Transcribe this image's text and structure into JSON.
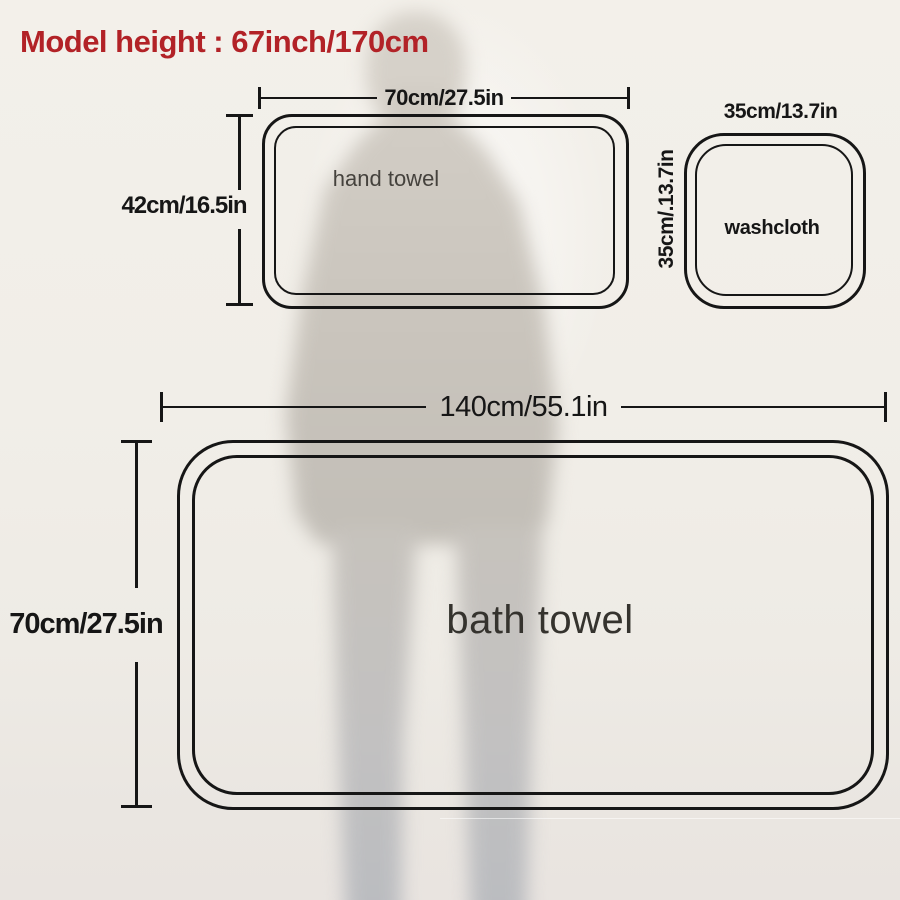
{
  "title": "Model height : 67inch/170cm",
  "colors": {
    "accent_red": "#b22227",
    "line_black": "#161616",
    "background_cream": "#f1eee8"
  },
  "diagram": {
    "hand_towel": {
      "name": "hand towel",
      "width_label": "70cm/27.5in",
      "height_label": "42cm/16.5in"
    },
    "washcloth": {
      "name": "washcloth",
      "width_label": "35cm/13.7in",
      "height_label": "35cm/.13.7in"
    },
    "bath_towel": {
      "name": "bath towel",
      "width_label": "140cm/55.1in",
      "height_label": "70cm/27.5in"
    }
  }
}
